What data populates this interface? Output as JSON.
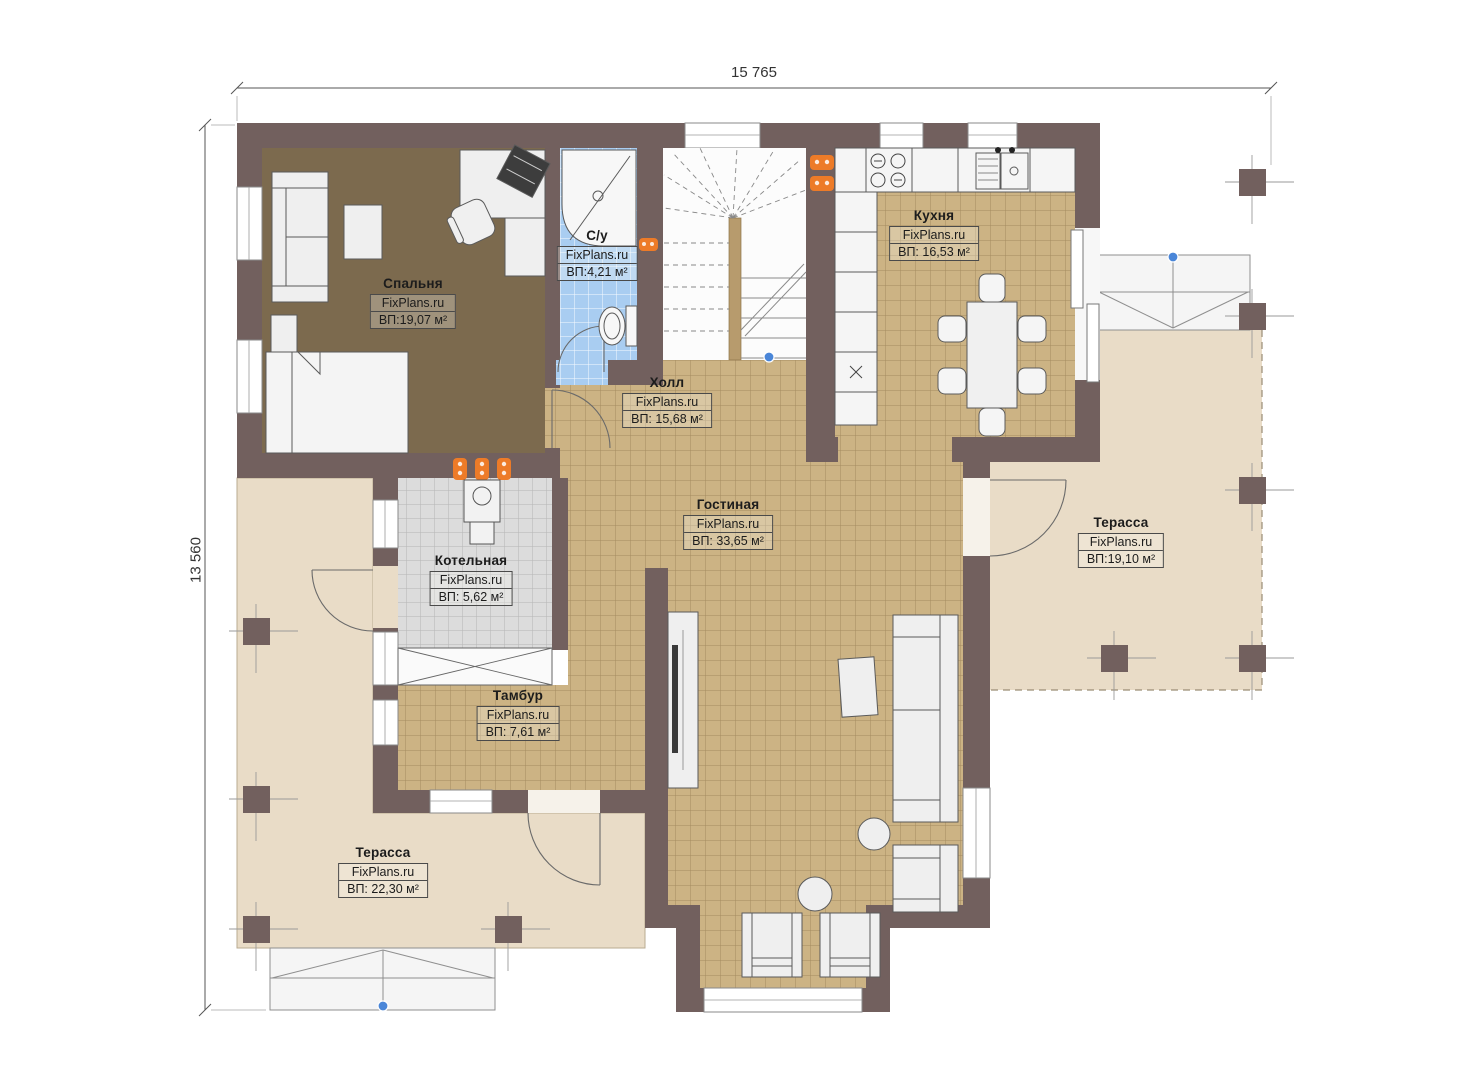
{
  "plan": {
    "watermark": "FixPlans.ru",
    "dimensions": {
      "top": "15 765",
      "left": "13 560"
    },
    "rooms": [
      {
        "id": "bedroom",
        "name": "Спальня",
        "area": "ВП:19,07 м²"
      },
      {
        "id": "bathroom",
        "name": "С/у",
        "area": "ВП:4,21 м²"
      },
      {
        "id": "kitchen",
        "name": "Кухня",
        "area": "ВП: 16,53 м²"
      },
      {
        "id": "hall",
        "name": "Холл",
        "area": "ВП: 15,68 м²"
      },
      {
        "id": "living",
        "name": "Гостиная",
        "area": "ВП: 33,65 м²"
      },
      {
        "id": "boiler",
        "name": "Котельная",
        "area": "ВП: 5,62 м²"
      },
      {
        "id": "vestibule",
        "name": "Тамбур",
        "area": "ВП: 7,61 м²"
      },
      {
        "id": "terrace-right",
        "name": "Терасса",
        "area": "ВП:19,10 м²"
      },
      {
        "id": "terrace-left",
        "name": "Терасса",
        "area": "ВП: 22,30 м²"
      }
    ],
    "colors": {
      "wall": "#72605e",
      "bedroom_floor": "#7c6a4e",
      "tile_floor": "#ccb384",
      "bath_floor": "#a9cdf1",
      "boiler_floor": "#dcdcdc",
      "terrace_floor": "#e9dcc7",
      "radiator": "#ed7b28",
      "level_marker": "#4a86d8"
    }
  }
}
